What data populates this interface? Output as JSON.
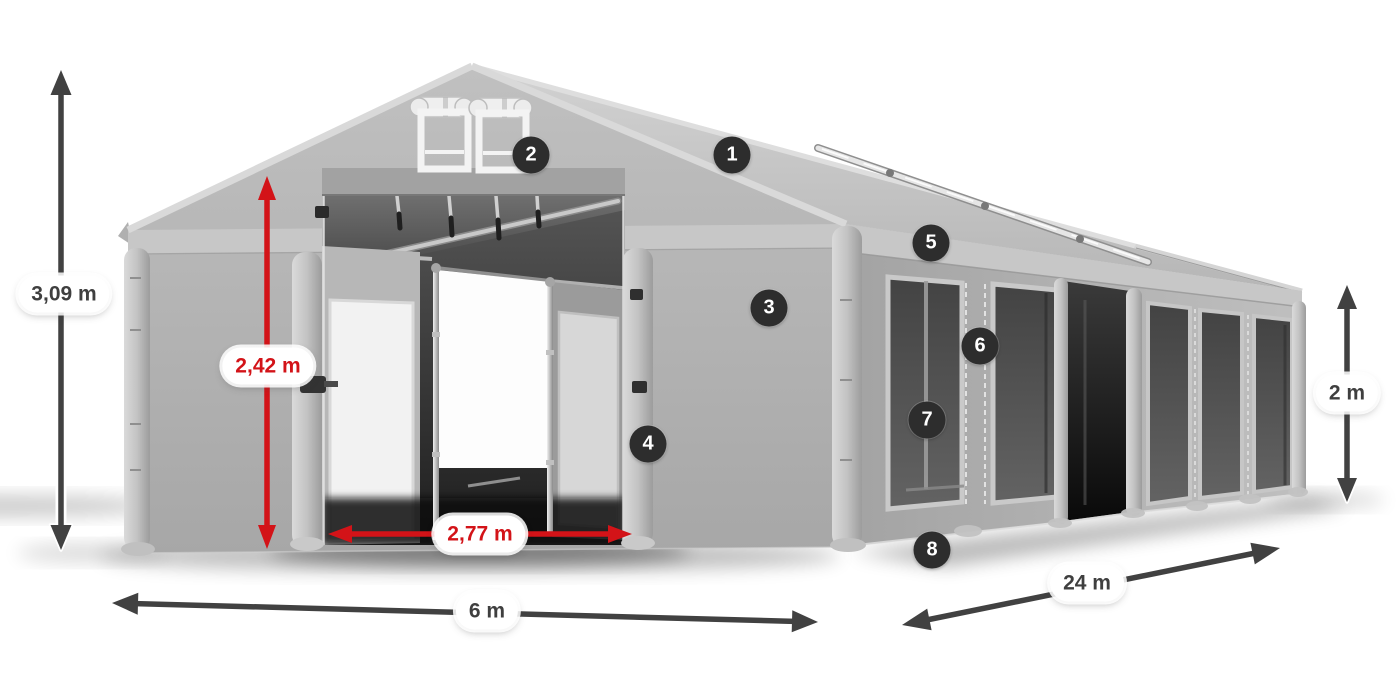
{
  "diagram": {
    "dimension_labels": {
      "total_height": "3,09 m",
      "door_height": "2,42 m",
      "door_width": "2,77 m",
      "front_width": "6 m",
      "side_length": "24 m",
      "side_wall_height": "2 m"
    },
    "callouts": [
      {
        "number": "1"
      },
      {
        "number": "2"
      },
      {
        "number": "3"
      },
      {
        "number": "4"
      },
      {
        "number": "5"
      },
      {
        "number": "6"
      },
      {
        "number": "7"
      },
      {
        "number": "8"
      }
    ],
    "colors": {
      "background": "#ffffff",
      "accent_red": "#d31318",
      "arrow_dark": "#414141",
      "badge_background": "#2d2d2d",
      "badge_text": "#ffffff",
      "label_text": "#3f3f3f",
      "label_background": "#ffffff",
      "tarp_light": "#cfcfcf",
      "tarp_mid": "#b3b3b3",
      "mesh_dark": "#4a4a4a"
    }
  }
}
